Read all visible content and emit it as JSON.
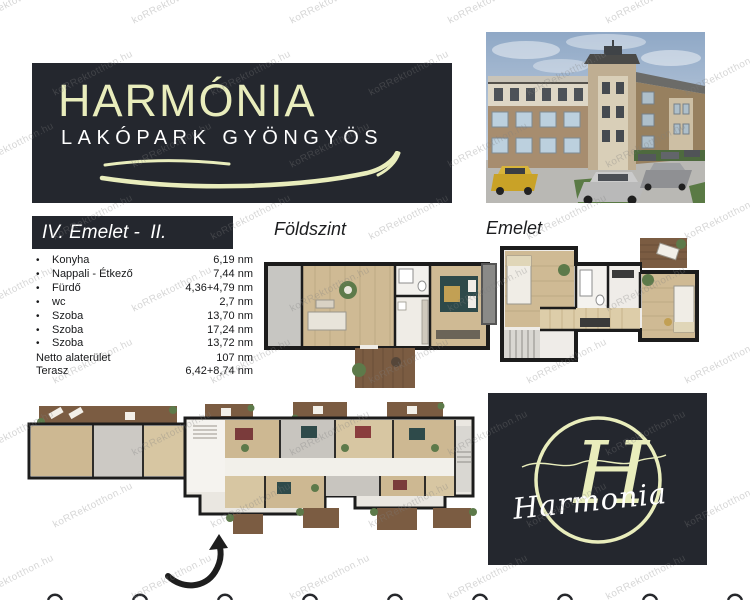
{
  "watermark": {
    "text": "koRRektotthon.hu"
  },
  "header": {
    "title": "HARMÓNIA",
    "subtitle": "LAKÓPARK GYÖNGYÖS"
  },
  "unit": {
    "title": "IV. Emelet -  II.",
    "rooms": [
      {
        "label": "Konyha",
        "value": "6,19 nm"
      },
      {
        "label": "Nappali - Étkező",
        "value": "7,44 nm"
      },
      {
        "label": "Fürdő",
        "value": "4,36+4,79 nm"
      },
      {
        "label": "wc",
        "value": "2,7 nm"
      },
      {
        "label": "Szoba",
        "value": "13,70 nm"
      },
      {
        "label": "Szoba",
        "value": "17,24 nm"
      },
      {
        "label": "Szoba",
        "value": "13,72 nm"
      }
    ],
    "summary": [
      {
        "label": "Netto alaterület",
        "value": "107 nm"
      },
      {
        "label": "Terasz",
        "value": "6,42+8,74 nm"
      }
    ]
  },
  "floorplans": {
    "ground_label": "Földszint",
    "upper_label": "Emelet"
  },
  "logo": {
    "monogram": "H",
    "script": "Harmonia"
  },
  "colors": {
    "panel_dark": "#24272e",
    "cream": "#e9edbc",
    "white": "#ffffff",
    "wall": "#1c1c1c",
    "wood": "#cfba94",
    "terrace": "#7b5c42",
    "text_dark": "#17181a"
  }
}
